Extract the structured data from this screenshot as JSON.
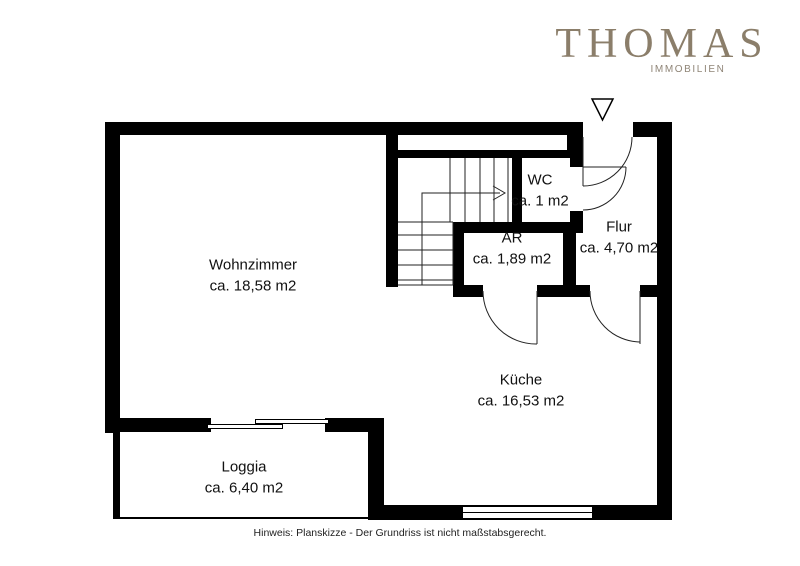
{
  "brand": {
    "name": "THOMAS",
    "tagline": "IMMOBILIEN"
  },
  "rooms": {
    "wohnzimmer": {
      "name": "Wohnzimmer",
      "area": "ca. 18,58 m2"
    },
    "wc": {
      "name": "WC",
      "area": "ca. 1 m2"
    },
    "ar": {
      "name": "AR",
      "area": "ca. 1,89 m2"
    },
    "flur": {
      "name": "Flur",
      "area": "ca. 4,70 m2"
    },
    "kueche": {
      "name": "Küche",
      "area": "ca. 16,53 m2"
    },
    "loggia": {
      "name": "Loggia",
      "area": "ca. 6,40 m2"
    }
  },
  "footer": {
    "disclaimer": "Hinweis: Planskizze - Der Grundriss ist nicht maßstabsgerecht."
  },
  "colors": {
    "brand": "#8b7e6a",
    "wall": "#000000",
    "text": "#111111"
  }
}
